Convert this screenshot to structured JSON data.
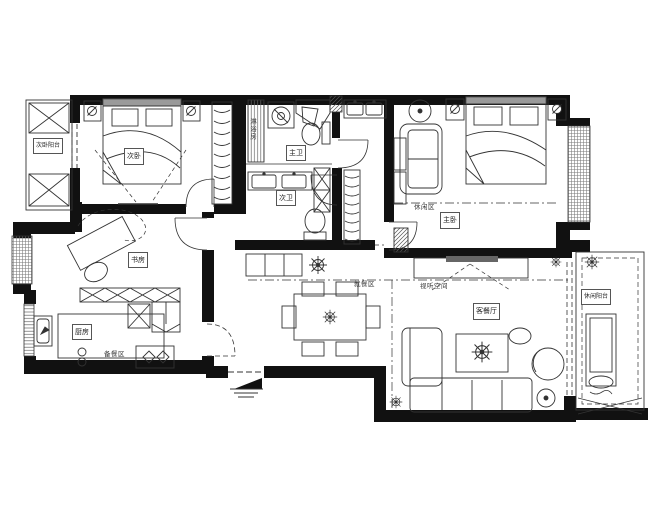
{
  "canvas": {
    "width": 650,
    "height": 520,
    "background": "#ffffff",
    "wall_color": "#111111",
    "line_color": "#333333"
  },
  "labels": {
    "balcony_left": "次卧阳台",
    "secondary_bedroom": "次卧",
    "shower_room": "淋浴房",
    "master_bath": "主卫",
    "second_bath": "次卫",
    "master_bedroom": "主卧",
    "leisure_zone": "休闲区",
    "study": "书房",
    "kitchen": "厨房",
    "prep_area": "备餐区",
    "dining_area": "就餐区",
    "av_zone": "视听空间",
    "living_dining": "客餐厅",
    "leisure_balcony": "休闲阳台"
  },
  "icons": {
    "plant": "starburst-foliage",
    "lamp": "circle-slash",
    "entry_arrow": "filled-triangle-with-steps",
    "window": "striped-band",
    "wardrobe": "hanger-arcs"
  }
}
